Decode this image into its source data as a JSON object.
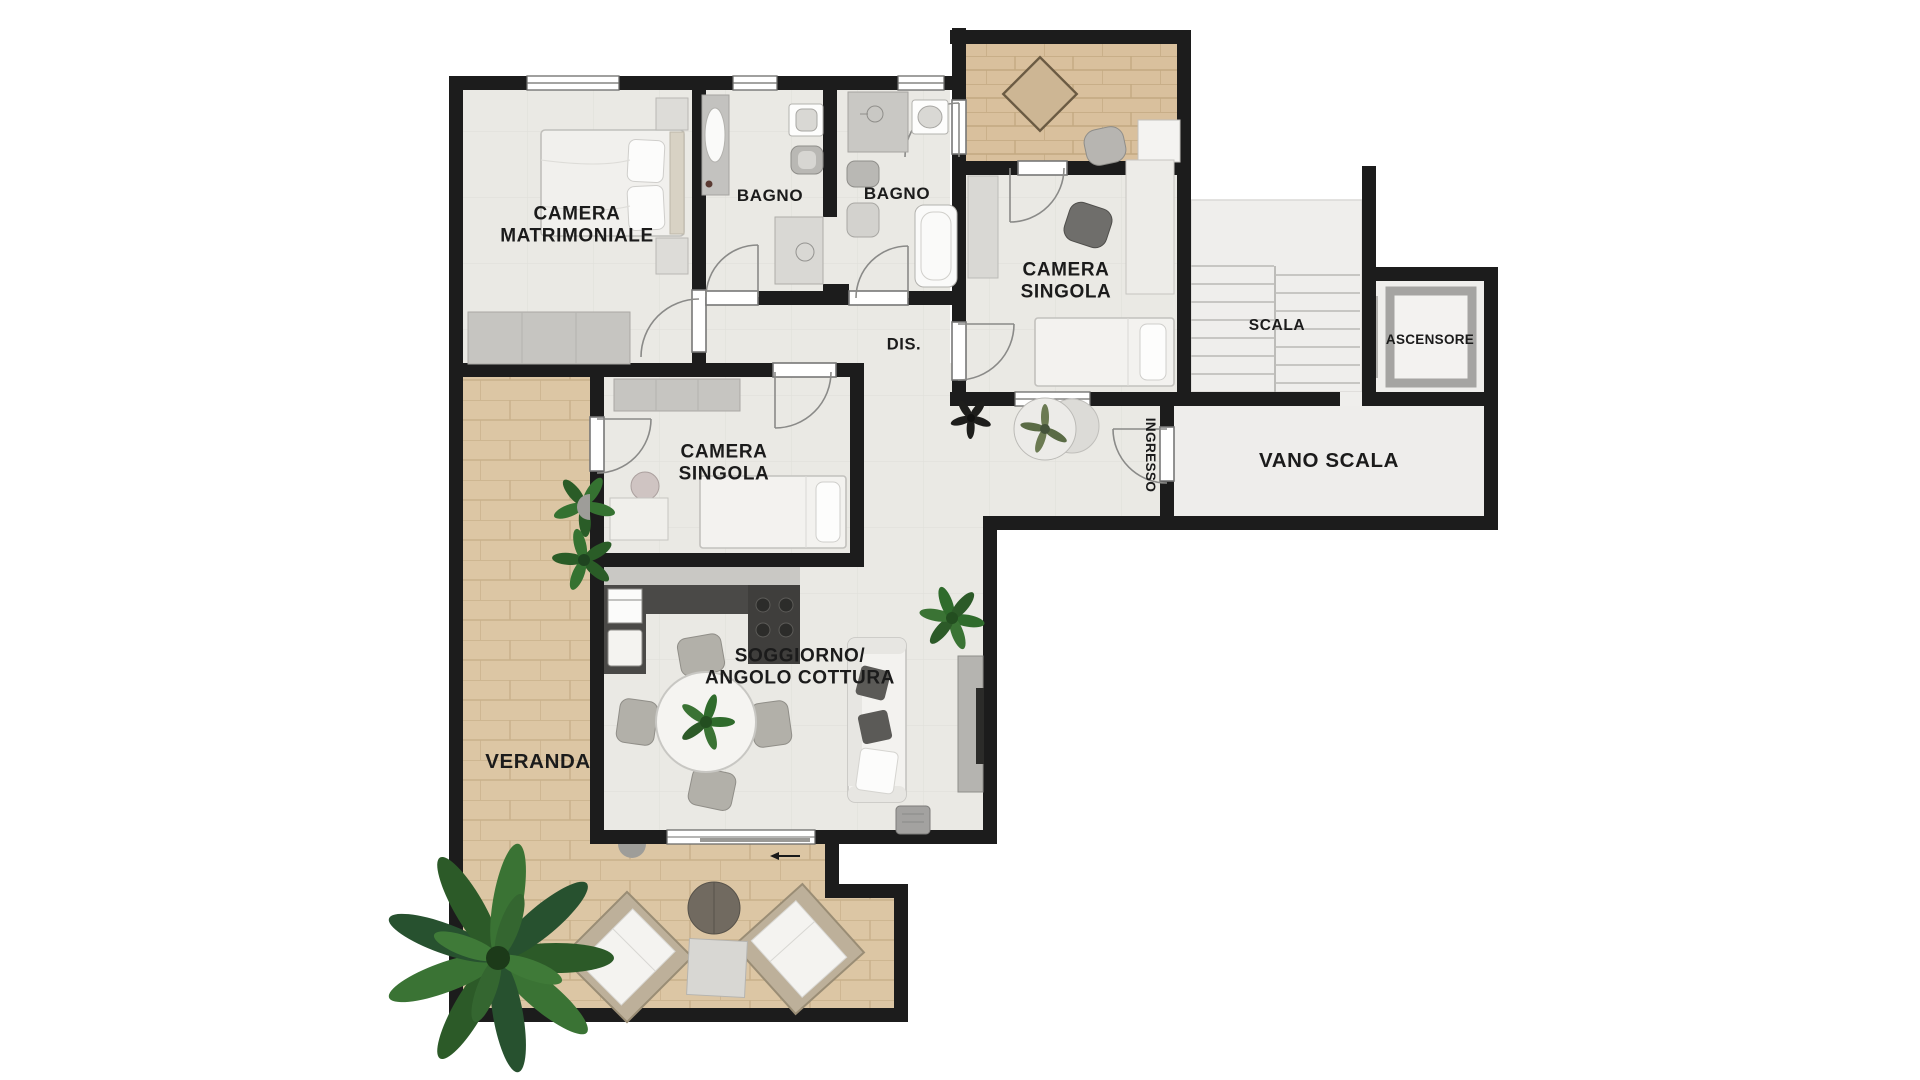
{
  "plan": {
    "type": "apartment-floor-plan",
    "rooms": [
      {
        "id": "camera-matrimoniale",
        "label": "CAMERA\nMATRIMONIALE"
      },
      {
        "id": "bagno-1",
        "label": "BAGNO"
      },
      {
        "id": "bagno-2",
        "label": "BAGNO"
      },
      {
        "id": "camera-singola-upper",
        "label": "CAMERA\nSINGOLA"
      },
      {
        "id": "dis",
        "label": "DIS."
      },
      {
        "id": "scala",
        "label": "SCALA"
      },
      {
        "id": "ascensore",
        "label": "ASCENSORE"
      },
      {
        "id": "vano-scala",
        "label": "VANO SCALA"
      },
      {
        "id": "ingresso",
        "label": "INGRESSO"
      },
      {
        "id": "camera-singola-lower",
        "label": "CAMERA\nSINGOLA"
      },
      {
        "id": "soggiorno",
        "label": "SOGGIORNO/\nANGOLO COTTURA"
      },
      {
        "id": "veranda",
        "label": "VERANDA"
      }
    ],
    "colors": {
      "wall": "#1c1c1c",
      "interior_floor": "#eae9e4",
      "terrace_brick": "#dcc6a4",
      "stair_floor": "#efeeec",
      "label_text": "#1b1b1b",
      "plant_green": "#3a7334",
      "kitchen_dark": "#4a4947"
    }
  }
}
